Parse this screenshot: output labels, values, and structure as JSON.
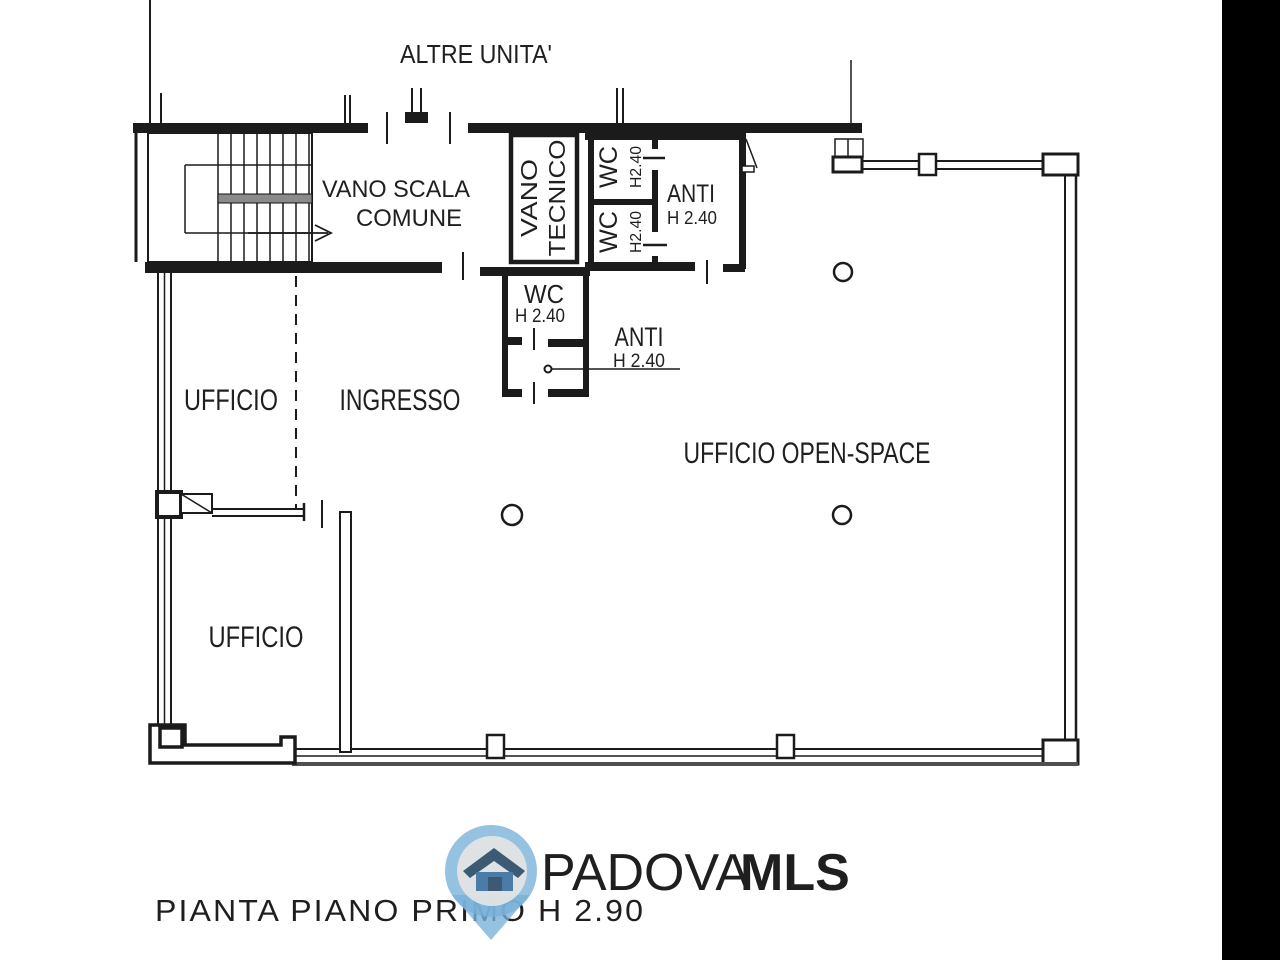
{
  "plan_labels": {
    "altre_unita": "ALTRE UNITA'",
    "vano_scala_line1": "VANO SCALA",
    "vano_scala_line2": "COMUNE",
    "vano_tecnico_line1": "VANO",
    "vano_tecnico_line2": "TECNICO",
    "wc_top": "WC",
    "wc_top_height": "H2.40",
    "wc_bottom": "WC",
    "wc_bottom_height": "H2.40",
    "anti_upper": "ANTI",
    "anti_upper_height": "H 2.40",
    "wc_main": "WC",
    "wc_main_height": "H 2.40",
    "anti_lower": "ANTI",
    "anti_lower_height": "H 2.40",
    "ufficio_upper": "UFFICIO",
    "ingresso": "INGRESSO",
    "ufficio_lower": "UFFICIO",
    "ufficio_open_space": "UFFICIO OPEN-SPACE"
  },
  "title": "PIANTA PIANO PRIMO H 2.90",
  "logo": {
    "brand_primary": "PADOVA",
    "brand_secondary": "MLS",
    "icon": "house-pin-icon"
  },
  "colors": {
    "wall_line": "#1b1b1b",
    "stair_rail_gray": "#8a8a8a",
    "window_sill_gray": "#4f4f4f",
    "logo_pin_blue": "#79b1d8",
    "logo_inner_circle": "#e6e6e6",
    "logo_house_roof": "#3c5a74",
    "logo_house_body": "#4b7ba7",
    "logo_text_light": "#a6c8e2",
    "logo_text_dark": "#4d7fab",
    "scan_edge_black": "#000000"
  }
}
